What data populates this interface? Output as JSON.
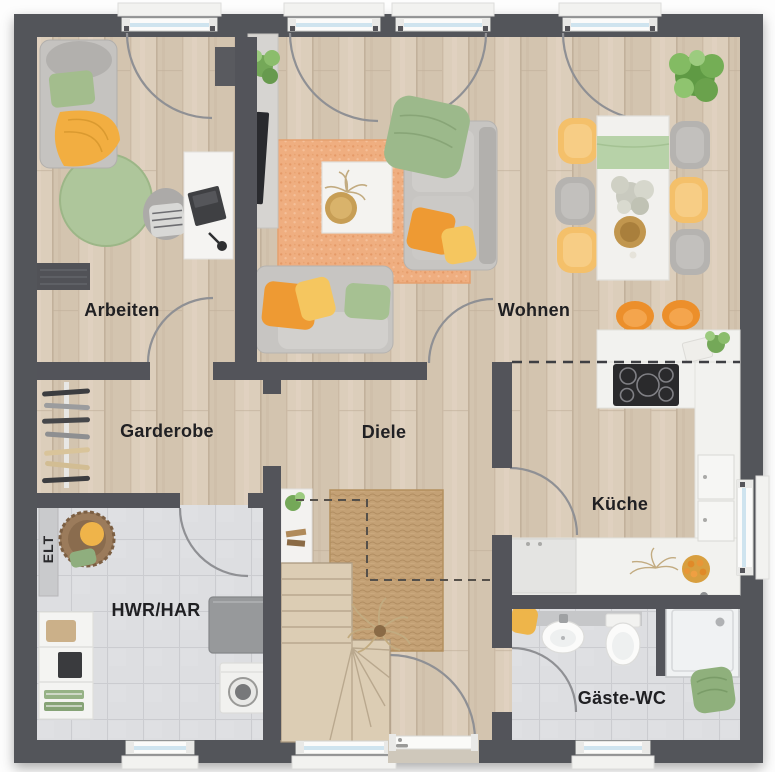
{
  "plan": {
    "type": "floor-plan",
    "rooms": [
      {
        "id": "arbeiten",
        "label": "Arbeiten"
      },
      {
        "id": "wohnen",
        "label": "Wohnen"
      },
      {
        "id": "garderobe",
        "label": "Garderobe"
      },
      {
        "id": "diele",
        "label": "Diele"
      },
      {
        "id": "kueche",
        "label": "Küche"
      },
      {
        "id": "hwr-har",
        "label": "HWR/HAR"
      },
      {
        "id": "gaeste-wc",
        "label": "Gäste-WC"
      },
      {
        "id": "elt",
        "label": "ELT"
      }
    ],
    "palette": {
      "wall": "#53545a",
      "floor_wood": "#d6c8b4",
      "floor_tile": "#dcdde0",
      "rug_orange": "#efae80",
      "rug_jute": "#c2a077",
      "rug_round_green": "#aec69b",
      "accent_orange": "#ee9a33",
      "accent_yellow": "#f5c65f",
      "accent_green": "#a0bd8c",
      "furniture_white": "#f4f3f1",
      "sofa_gray": "#c7c5c2",
      "window_glass": "#cfe4ef",
      "label_text": "#202023"
    },
    "furniture": {
      "arbeiten": [
        "daybed",
        "green-pillow",
        "yellow-throw",
        "round-rug",
        "office-chair",
        "desk",
        "laptop",
        "wall-shelf",
        "radiator"
      ],
      "wohnen": [
        "tv-sideboard",
        "tv",
        "potted-plant",
        "orange-rug",
        "coffee-table",
        "decor-tray",
        "corner-sofa",
        "green-blanket",
        "cushions",
        "dining-table",
        "table-runner",
        "dining-chairs",
        "flower-centerpiece",
        "gold-bowl",
        "fern-plant",
        "bar-stools"
      ],
      "kueche": [
        "peninsula-counter",
        "induction-hob",
        "tall-counter",
        "base-cabinets",
        "worktop-plant",
        "cutting-board",
        "dried-flowers",
        "fruit-bowl"
      ],
      "garderobe": [
        "coat-rack",
        "hangers"
      ],
      "diele": [
        "console-shelf",
        "jute-rug",
        "headroom-dashed-line",
        "staircase",
        "dried-grass",
        "entrance-door"
      ],
      "hwr-har": [
        "elt-panel",
        "laundry-basket",
        "storage-shelf",
        "heat-pump",
        "washing-machine"
      ],
      "gaeste-wc": [
        "vanity-sink",
        "toilet",
        "shower",
        "green-towel",
        "yellow-towel"
      ]
    },
    "openings": {
      "windows_top": 4,
      "windows_bottom": 3,
      "windows_right": 1,
      "doors": [
        "arbeiten-garderobe",
        "wohnen-diele",
        "diele-kueche",
        "garderobe-hwr",
        "diele-gaeste-wc",
        "entrance",
        "terrace"
      ]
    }
  }
}
